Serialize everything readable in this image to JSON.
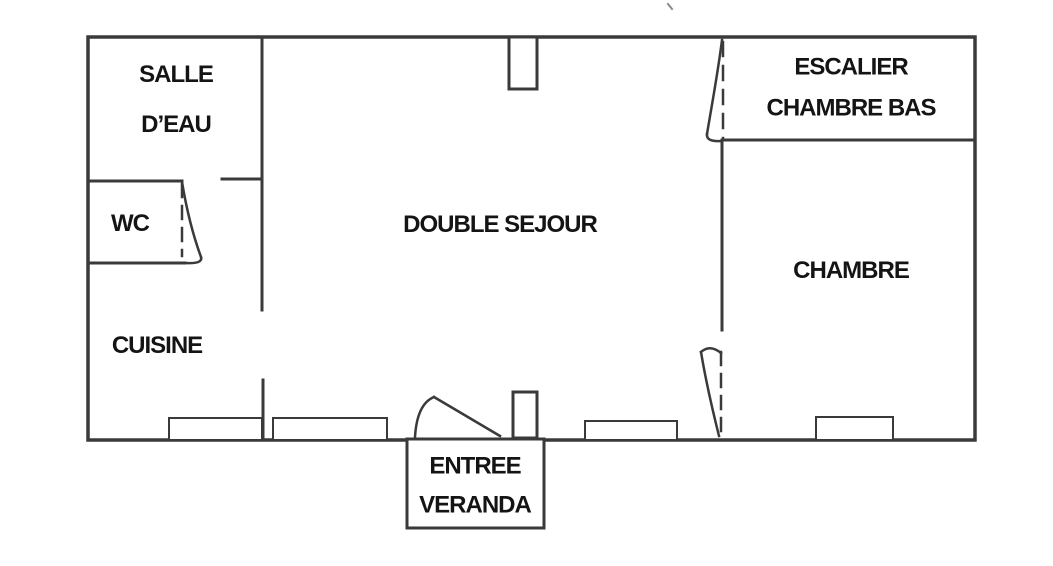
{
  "figure": {
    "type": "floor-plan",
    "colors": {
      "wall": "#3a3a3a",
      "text": "#141414",
      "background": "#ffffff"
    }
  },
  "rooms": {
    "salle_deau": {
      "line1": "SALLE",
      "line2": "D’EAU"
    },
    "wc": {
      "label": "WC"
    },
    "cuisine": {
      "label": "CUISINE"
    },
    "double_sejour": {
      "label": "DOUBLE SEJOUR"
    },
    "escalier_chambre_bas": {
      "line1": "ESCALIER",
      "line2": "CHAMBRE BAS"
    },
    "chambre": {
      "label": "CHAMBRE"
    },
    "entree_veranda": {
      "line1": "ENTREE",
      "line2": "VERANDA"
    }
  }
}
